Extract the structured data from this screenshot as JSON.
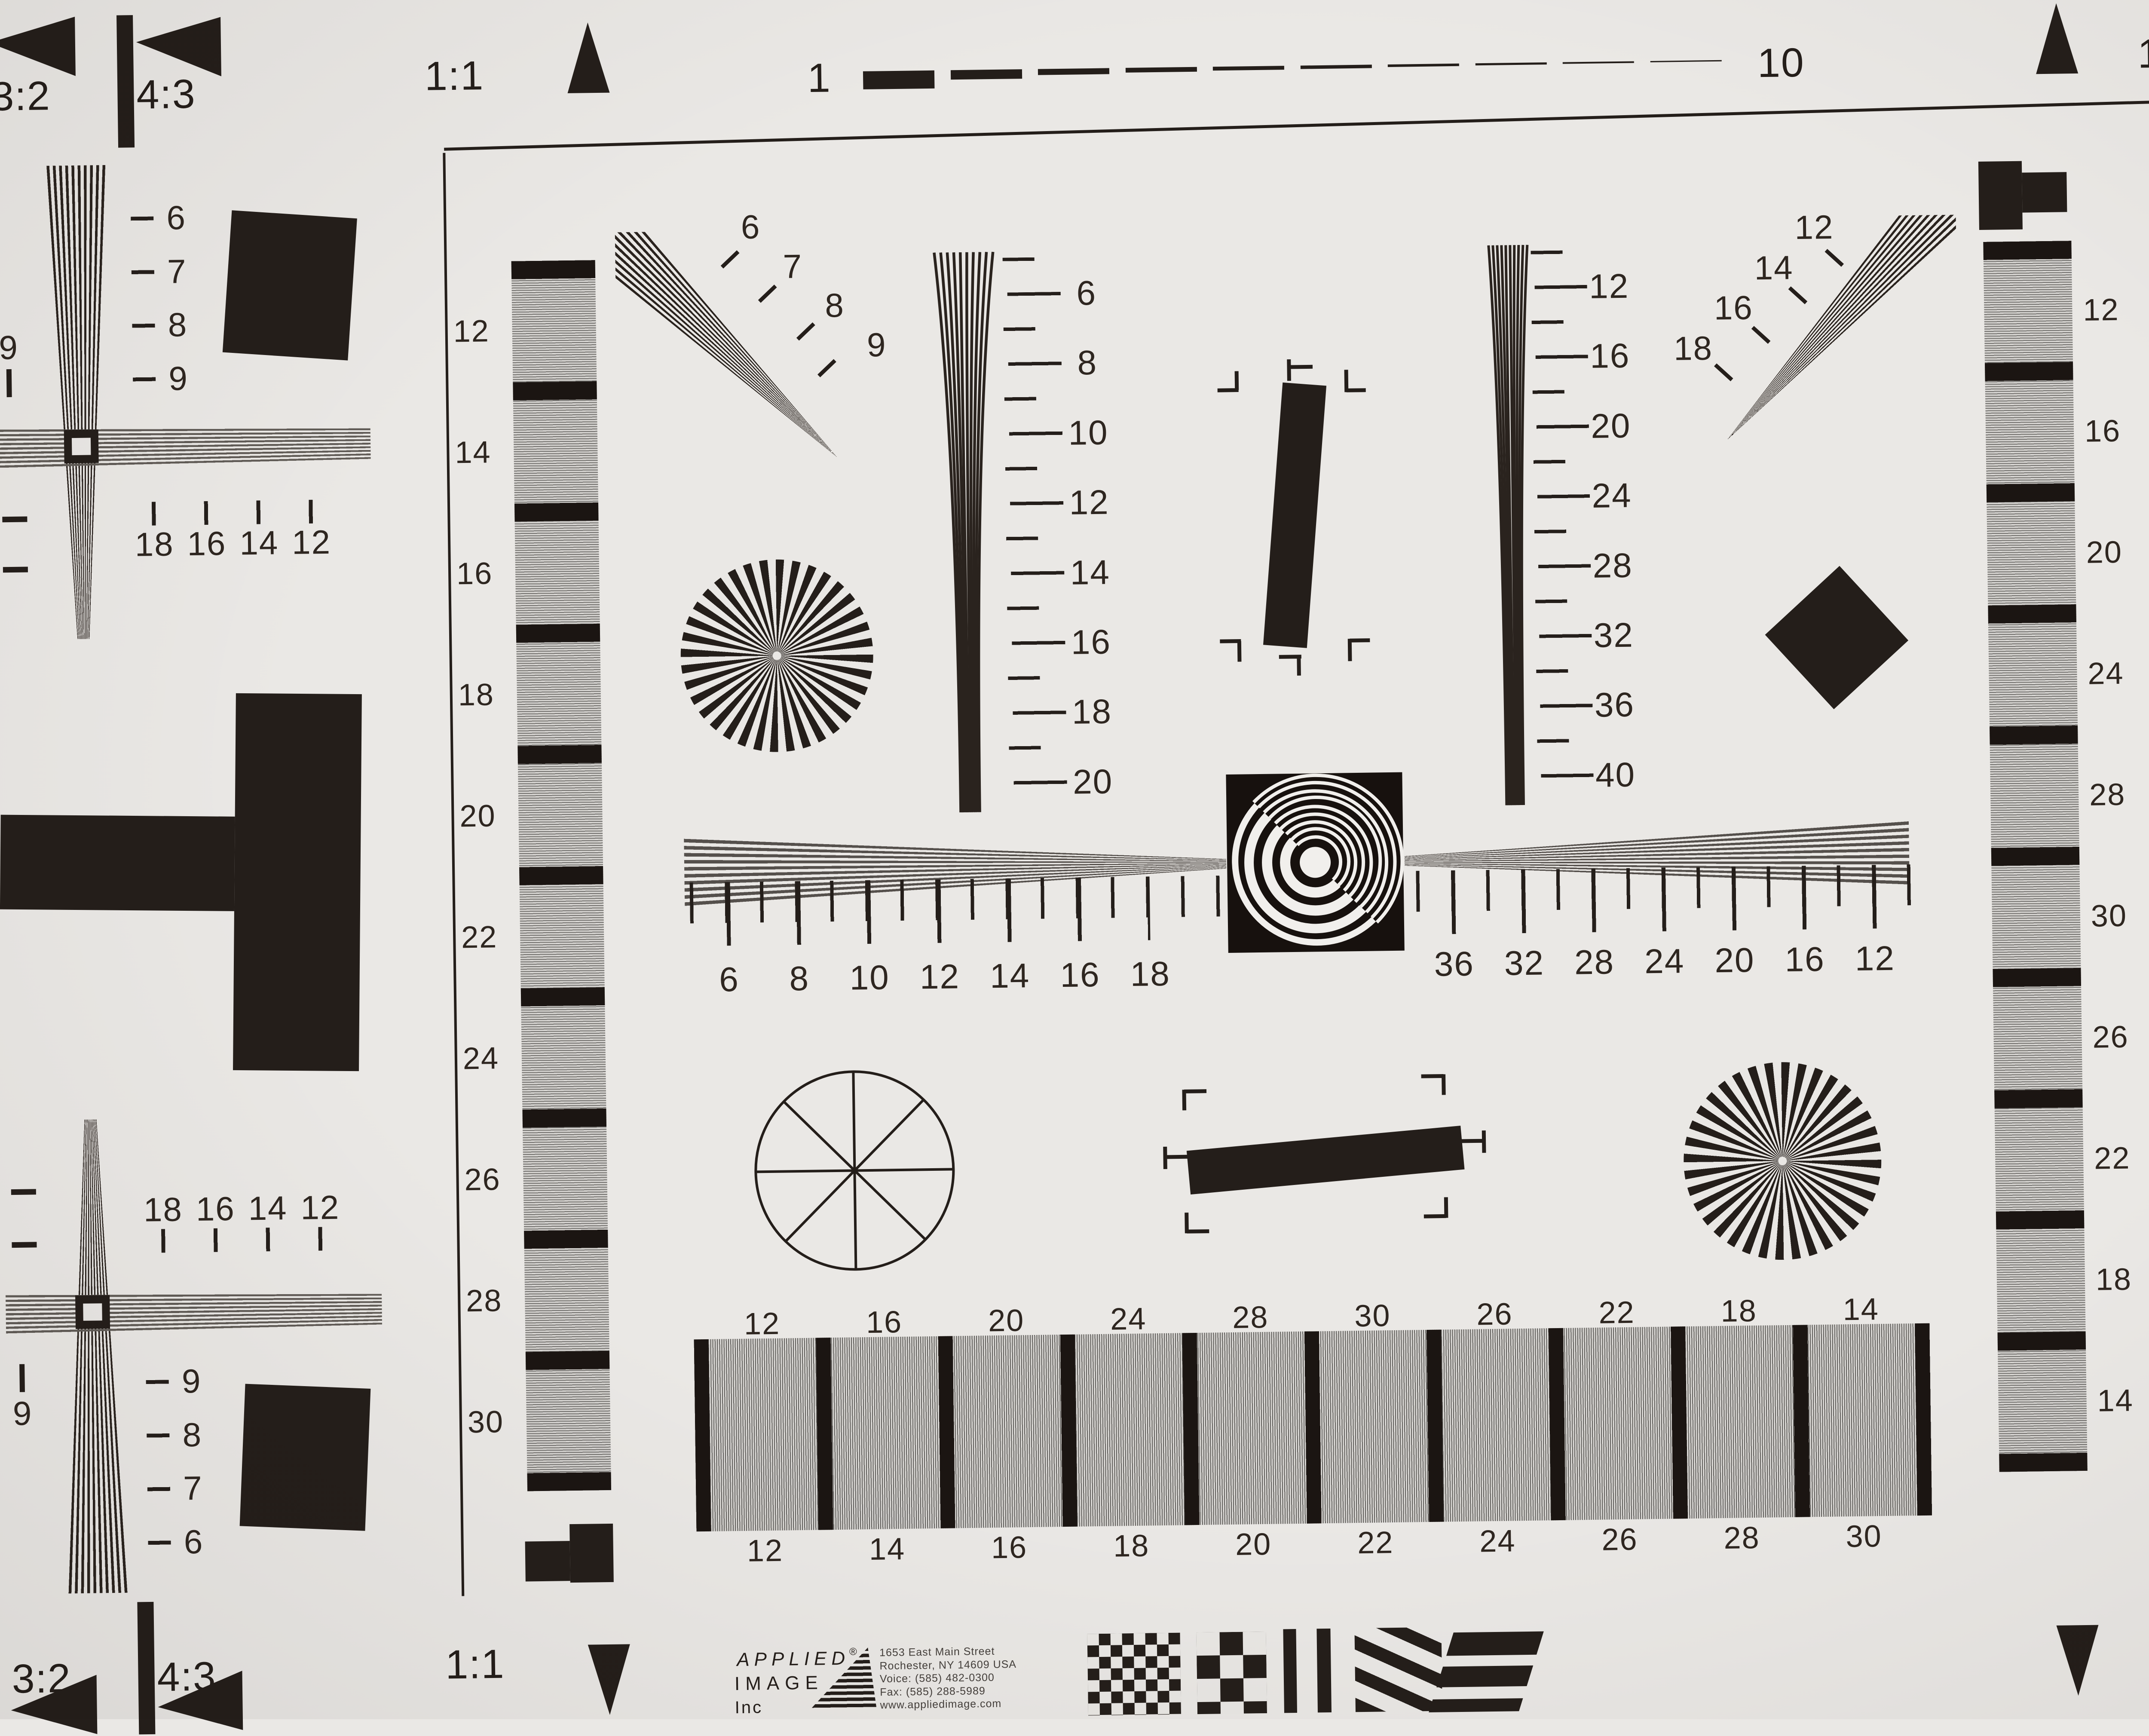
{
  "chart_name": "resolution-test-chart",
  "colors": {
    "paper": "#eae8e5",
    "ink": "#241e1a",
    "gray_band": "#a9a7a4"
  },
  "corners": {
    "top_left": {
      "r32": "3:2",
      "r43": "4:3",
      "r11": "1:1"
    },
    "top_right": {
      "r11": "1:1",
      "r43": "4:3",
      "r32": "3:2"
    },
    "bottom_left": {
      "r32": "3:2",
      "r43": "4:3",
      "r11": "1:1"
    },
    "bottom_right": {
      "r11": "1:1",
      "r43": "4:3",
      "r32": "3:2"
    }
  },
  "top_scale": {
    "start": "1",
    "end": "10"
  },
  "edge_nines": [
    "9",
    "9",
    "9",
    "9"
  ],
  "left_upper_fan_labels": [
    "6",
    "7",
    "8",
    "9"
  ],
  "left_lower_fan_labels": [
    "9",
    "8",
    "7",
    "6"
  ],
  "right_upper_fan_labels": [
    "6",
    "7",
    "8",
    "9"
  ],
  "right_lower_fan_labels": [
    "9",
    "8",
    "7",
    "6"
  ],
  "left_upper_cross_scale": [
    "18",
    "16",
    "14",
    "12"
  ],
  "left_lower_cross_scale": [
    "18",
    "16",
    "14",
    "12"
  ],
  "right_upper_cross_scale": [
    "12",
    "14",
    "16",
    "18"
  ],
  "right_lower_cross_scale": [
    "12",
    "14",
    "16",
    "18"
  ],
  "left_strip_labels": [
    "12",
    "14",
    "16",
    "18",
    "20",
    "22",
    "24",
    "26",
    "28",
    "30"
  ],
  "right_strip_labels": [
    "12",
    "16",
    "20",
    "24",
    "28",
    "30",
    "26",
    "22",
    "18",
    "14"
  ],
  "inner_fan_left_labels": [
    "6",
    "7",
    "8",
    "9"
  ],
  "inner_fan_right_labels": [
    "12",
    "14",
    "16",
    "18"
  ],
  "center_wedge_scale": [
    "6",
    "8",
    "10",
    "12",
    "14",
    "16",
    "18",
    "20"
  ],
  "right_wedge_scale": [
    "12",
    "16",
    "20",
    "24",
    "28",
    "32",
    "36",
    "40"
  ],
  "h_ruler_left": [
    "6",
    "8",
    "10",
    "12",
    "14",
    "16",
    "18"
  ],
  "h_ruler_right": [
    "36",
    "32",
    "28",
    "24",
    "20",
    "16",
    "12"
  ],
  "bottom_bar_top_labels": [
    "12",
    "16",
    "20",
    "24",
    "28",
    "30",
    "26",
    "22",
    "18",
    "14"
  ],
  "bottom_bar_bottom_labels": [
    "12",
    "14",
    "16",
    "18",
    "20",
    "22",
    "24",
    "26",
    "28",
    "30"
  ],
  "logo": {
    "name_line1": "APPLIED",
    "name_line2": "IMAGE",
    "name_line3": "Inc",
    "reg": "®",
    "address": [
      "1653 East Main Street",
      "Rochester, NY  14609  USA",
      "Voice:   (585) 482-0300",
      "Fax:      (585) 288-5989",
      "www.appliedimage.com"
    ]
  }
}
